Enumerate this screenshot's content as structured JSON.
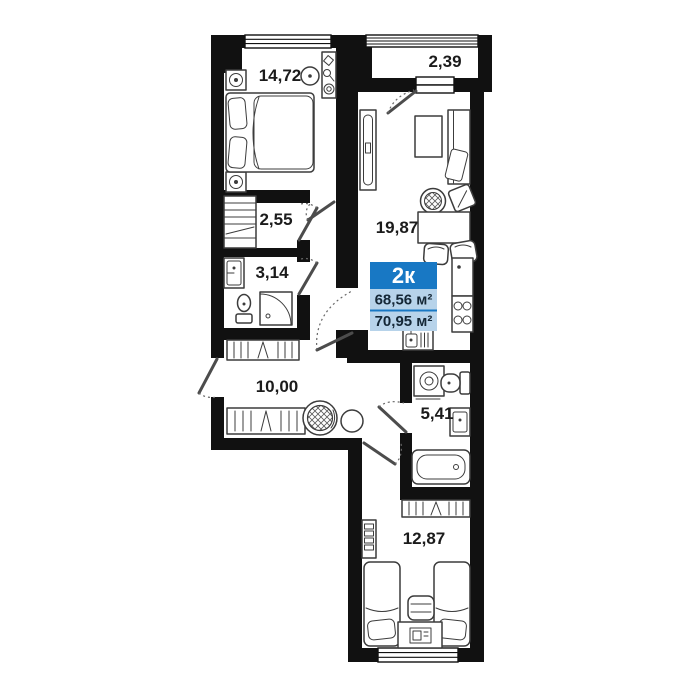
{
  "plan": {
    "badge": {
      "type": "2к",
      "area1": "68,56 м²",
      "area2": "70,95 м²"
    },
    "rooms": [
      {
        "name": "bedroom",
        "area": "14,72"
      },
      {
        "name": "balcony",
        "area": "2,39"
      },
      {
        "name": "living-kitchen",
        "area": "19,87"
      },
      {
        "name": "closet",
        "area": "2,55"
      },
      {
        "name": "bathroom",
        "area": "3,14"
      },
      {
        "name": "hallway",
        "area": "10,00"
      },
      {
        "name": "bathroom-2",
        "area": "5,41"
      },
      {
        "name": "bedroom-2",
        "area": "12,87"
      }
    ],
    "colors": {
      "badge_primary": "#1878c4",
      "badge_secondary": "#b7d3ea",
      "walls": "#111111",
      "background": "#ffffff",
      "furniture_stroke": "#3c3c3c"
    }
  }
}
